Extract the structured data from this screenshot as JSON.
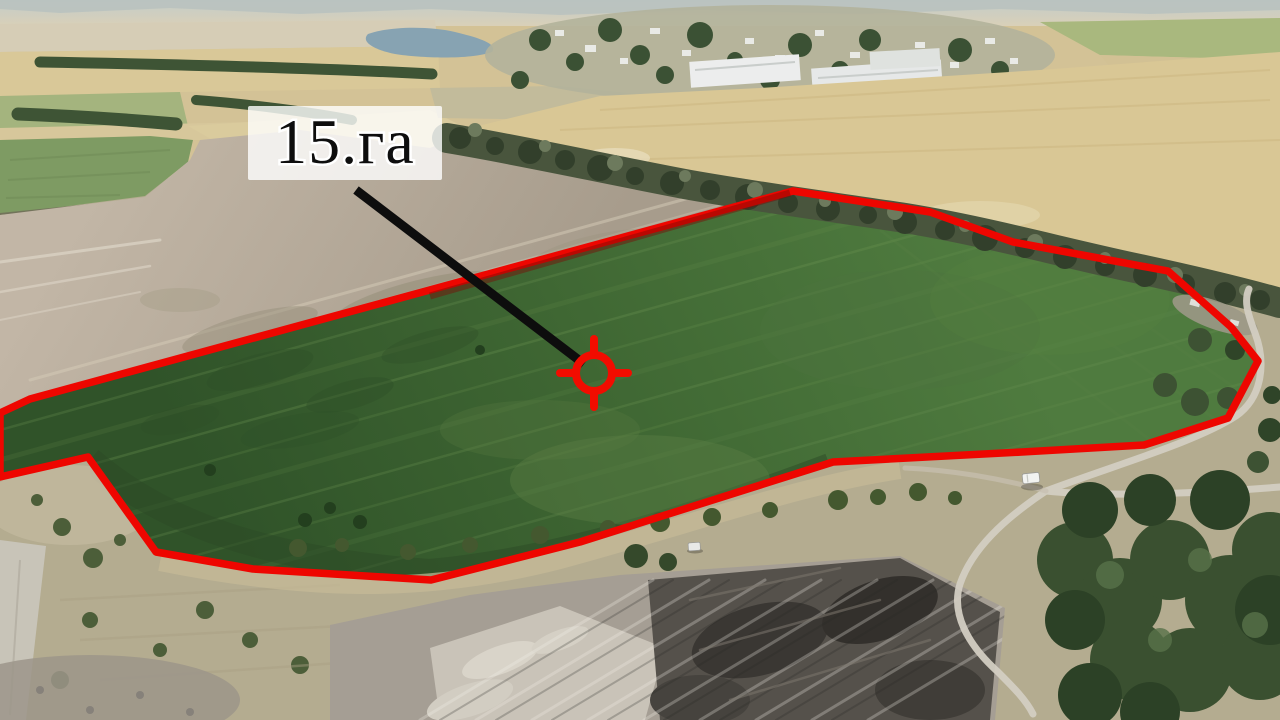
{
  "photo": {
    "kind": "aerial-drone-photo-of-farmland",
    "annotation": {
      "area_label": "15.га",
      "boundary_color": "#ee0600",
      "marker_color": "#f20c00",
      "pointer_color": "#0d0d0d",
      "label_background": "#ffffff",
      "label_text_color": "#0e0e0e",
      "marker_icon": "crosshair-target-icon"
    }
  }
}
